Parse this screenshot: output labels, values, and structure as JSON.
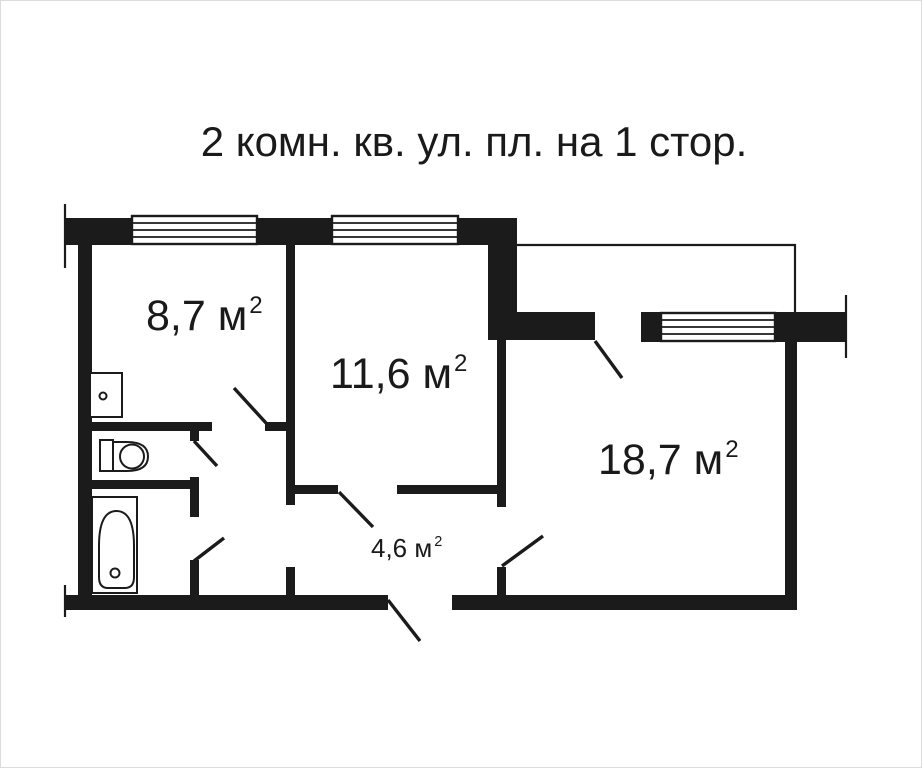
{
  "title": "2 комн. кв. ул. пл. на 1 стор.",
  "rooms": {
    "kitchen": {
      "area": "8,7 м",
      "sup": "2"
    },
    "bedroom": {
      "area": "11,6 м",
      "sup": "2"
    },
    "living_room": {
      "area": "18,7 м",
      "sup": "2"
    },
    "hallway": {
      "area": "4,6 м",
      "sup": "2"
    }
  },
  "colors": {
    "wall": "#1b1b1b",
    "text": "#1a1a1a",
    "background": "#ffffff"
  }
}
